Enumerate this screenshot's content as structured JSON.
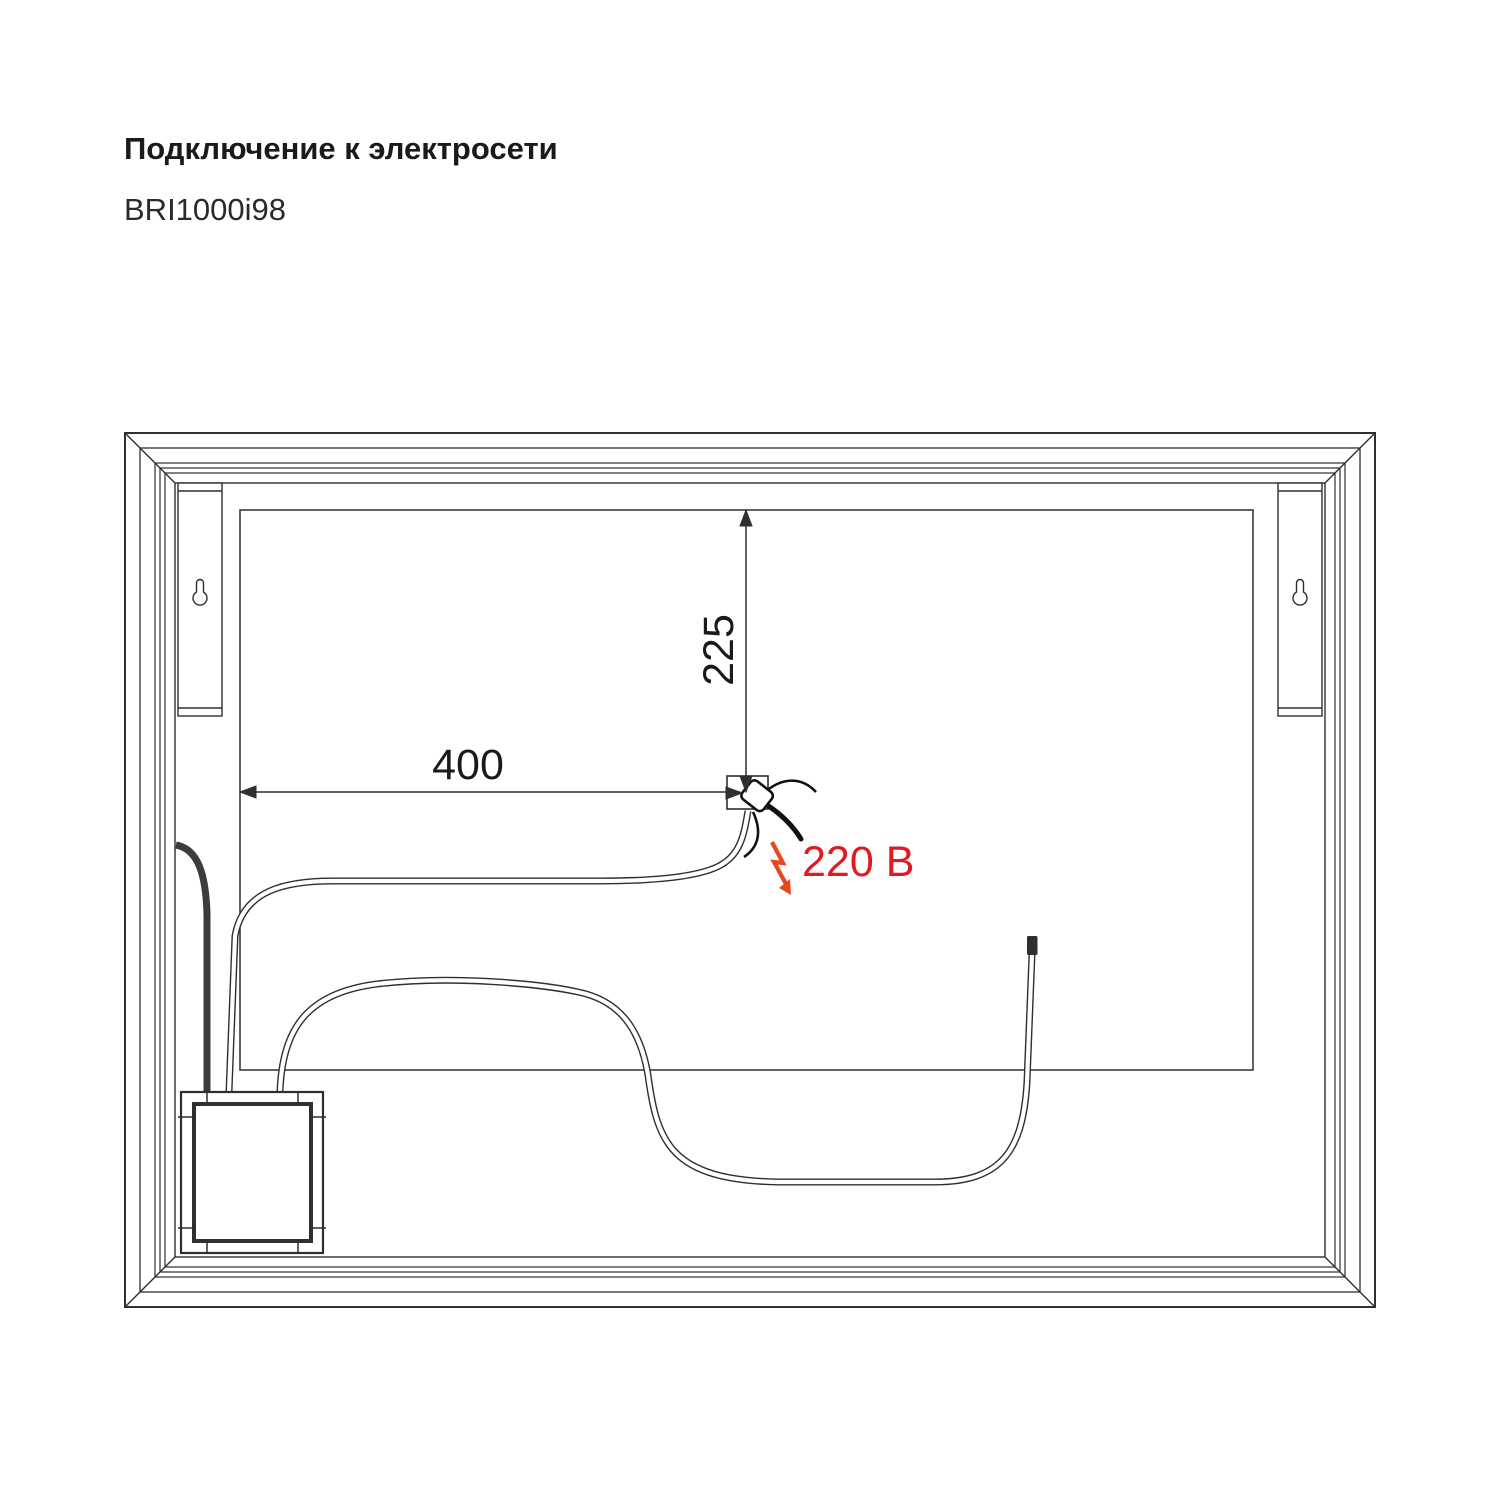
{
  "header": {
    "title": "Подключение к электросети",
    "model": "BRI1000i98"
  },
  "diagram": {
    "dim_horizontal": "400",
    "dim_vertical": "225",
    "voltage_label": "220 В",
    "mount_points": 2,
    "colors": {
      "line": "#2f2f2f",
      "voltage_text": "#e3191f",
      "bolt": "#e8481d"
    }
  }
}
